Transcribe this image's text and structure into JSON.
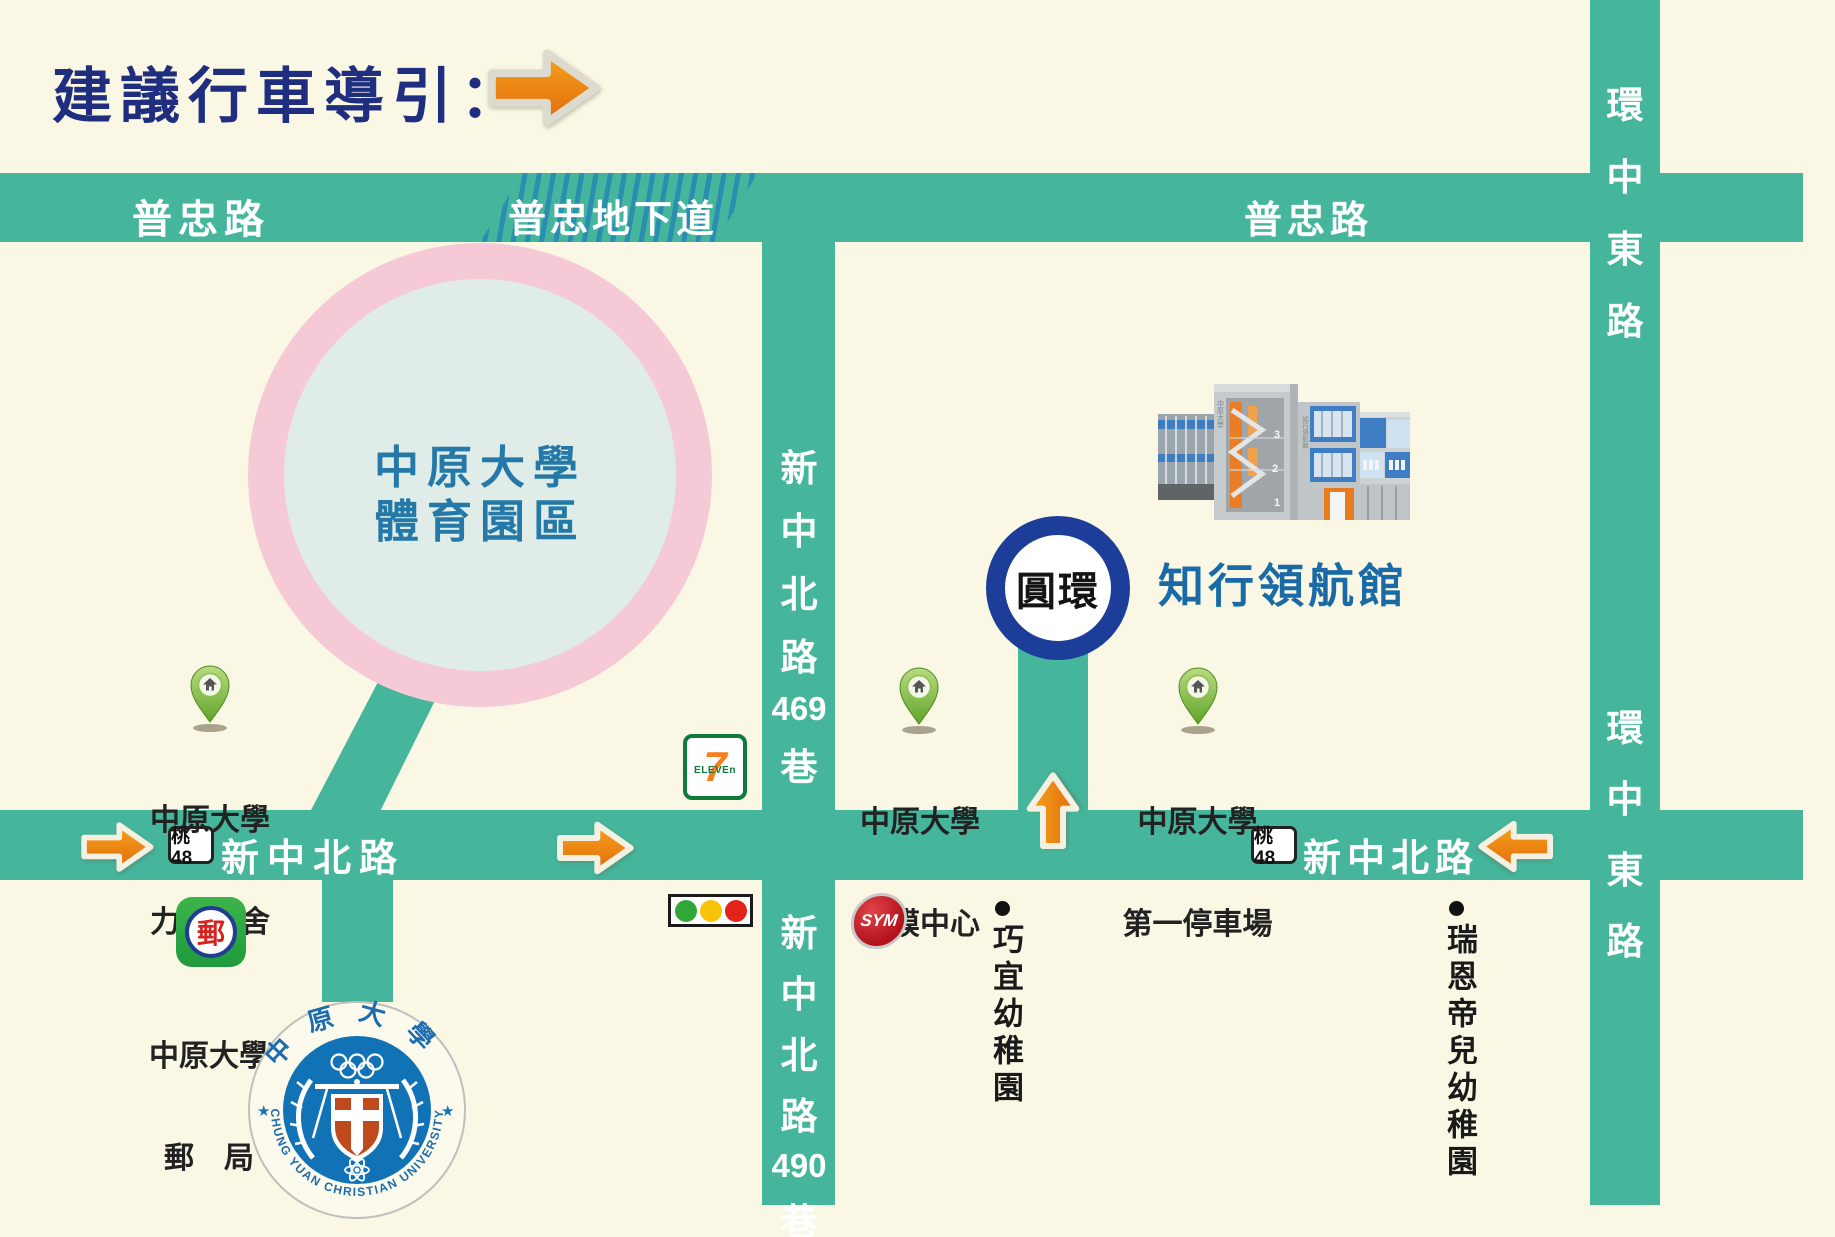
{
  "colors": {
    "background": "#FAF7E5",
    "road_green": "#45B69C",
    "title_navy": "#1F2E7E",
    "campus_blue": "#2579A8",
    "building_label_blue": "#1A6BA5",
    "roundabout_navy": "#1C3E99",
    "pink_ring": "#F5C9D6",
    "pink_inner": "#DFECE7",
    "arrow_orange": "#EE7D12",
    "hatch_blue": "#2B8DB0"
  },
  "title": {
    "label": "建議行車導引："
  },
  "roads": {
    "puzhong_left": "普忠路",
    "underpass": "普忠地下道",
    "puzhong_right": "普忠路",
    "xinzhongbei_left": "新中北路",
    "xinzhongbei_right": "新中北路",
    "shield48": "桃48",
    "huanzhong": {
      "c1": "環",
      "c2": "中",
      "c3": "東",
      "c4": "路"
    },
    "lane469": {
      "c1": "新",
      "c2": "中",
      "c3": "北",
      "c4": "路",
      "num": "469",
      "c5": "巷"
    },
    "lane490": {
      "c1": "新",
      "c2": "中",
      "c3": "北",
      "c4": "路",
      "num": "490",
      "c5": "巷"
    }
  },
  "landmarks": {
    "sports_park": {
      "line1": "中原大學",
      "line2": "體育園區"
    },
    "roundabout": "圓環",
    "building_name": "知行領航館",
    "building": {
      "side_text": "中原大學",
      "tower_text": "知行領航館",
      "floor3": "3",
      "floor2": "2",
      "floor1": "1"
    }
  },
  "pois": {
    "lixing": {
      "line1": "中原大學",
      "line2": "力行宿舍"
    },
    "thinfilm": {
      "line1": "中原大學",
      "line2": "薄膜中心"
    },
    "parking": {
      "line1": "中原大學",
      "line2": "第一停車場"
    },
    "post": {
      "line1": "中原大學",
      "line2": "郵　局",
      "icon_char": "郵"
    },
    "qiaoyi": "巧宜幼稚園",
    "ruiendier": "瑞恩帝兒幼稚園",
    "seven_eleven": {
      "seven": "7",
      "eleven": "ELEVEn"
    },
    "sym": "SYM"
  },
  "logo": {
    "top": "中原大學",
    "bottom": "CHUNG YUAN CHRISTIAN UNIVERSITY",
    "star_left": "★",
    "star_right": "★"
  }
}
